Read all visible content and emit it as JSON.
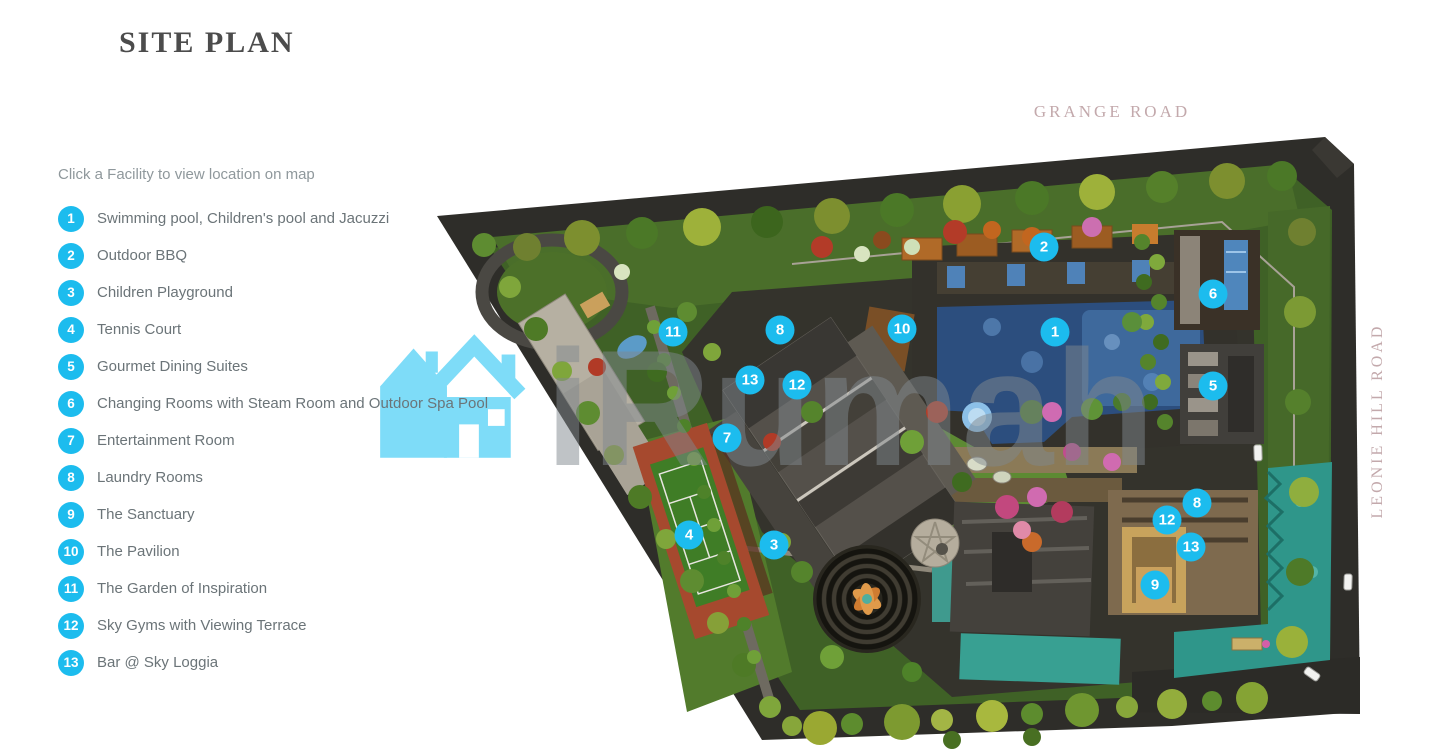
{
  "page": {
    "title": "SITE PLAN"
  },
  "facilities": {
    "instruction": "Click a Facility to view location on map",
    "items": [
      {
        "num": "1",
        "label": "Swimming pool, Children's pool and Jacuzzi"
      },
      {
        "num": "2",
        "label": "Outdoor BBQ"
      },
      {
        "num": "3",
        "label": "Children Playground"
      },
      {
        "num": "4",
        "label": "Tennis Court"
      },
      {
        "num": "5",
        "label": "Gourmet Dining Suites"
      },
      {
        "num": "6",
        "label": "Changing Rooms with Steam Room and Outdoor Spa Pool"
      },
      {
        "num": "7",
        "label": "Entertainment Room"
      },
      {
        "num": "8",
        "label": "Laundry Rooms"
      },
      {
        "num": "9",
        "label": "The Sanctuary"
      },
      {
        "num": "10",
        "label": "The Pavilion"
      },
      {
        "num": "11",
        "label": "The Garden of Inspiration"
      },
      {
        "num": "12",
        "label": "Sky Gyms with Viewing Terrace"
      },
      {
        "num": "13",
        "label": "Bar @ Sky Loggia"
      }
    ]
  },
  "map": {
    "road_label_top": "GRANGE ROAD",
    "road_label_right": "LEONIE HILL ROAD",
    "markers": [
      {
        "num": "1",
        "x": 623,
        "y": 220
      },
      {
        "num": "2",
        "x": 612,
        "y": 135
      },
      {
        "num": "3",
        "x": 342,
        "y": 433
      },
      {
        "num": "4",
        "x": 257,
        "y": 423
      },
      {
        "num": "5",
        "x": 781,
        "y": 274
      },
      {
        "num": "6",
        "x": 781,
        "y": 182
      },
      {
        "num": "7",
        "x": 295,
        "y": 326
      },
      {
        "num": "8",
        "x": 348,
        "y": 218
      },
      {
        "num": "8",
        "x": 765,
        "y": 391
      },
      {
        "num": "9",
        "x": 723,
        "y": 473
      },
      {
        "num": "10",
        "x": 470,
        "y": 217
      },
      {
        "num": "11",
        "x": 241,
        "y": 220
      },
      {
        "num": "12",
        "x": 365,
        "y": 273
      },
      {
        "num": "12",
        "x": 735,
        "y": 408
      },
      {
        "num": "13",
        "x": 318,
        "y": 268
      },
      {
        "num": "13",
        "x": 759,
        "y": 435
      }
    ]
  },
  "watermark": {
    "text": "iRumah"
  },
  "colors": {
    "accent": "#1cbcee",
    "watermark_blue": "#7edcf8",
    "road_label": "#c3a9ac",
    "title": "#4c4c4c",
    "list_text": "#6b7478",
    "instruction_text": "#8f989c"
  }
}
